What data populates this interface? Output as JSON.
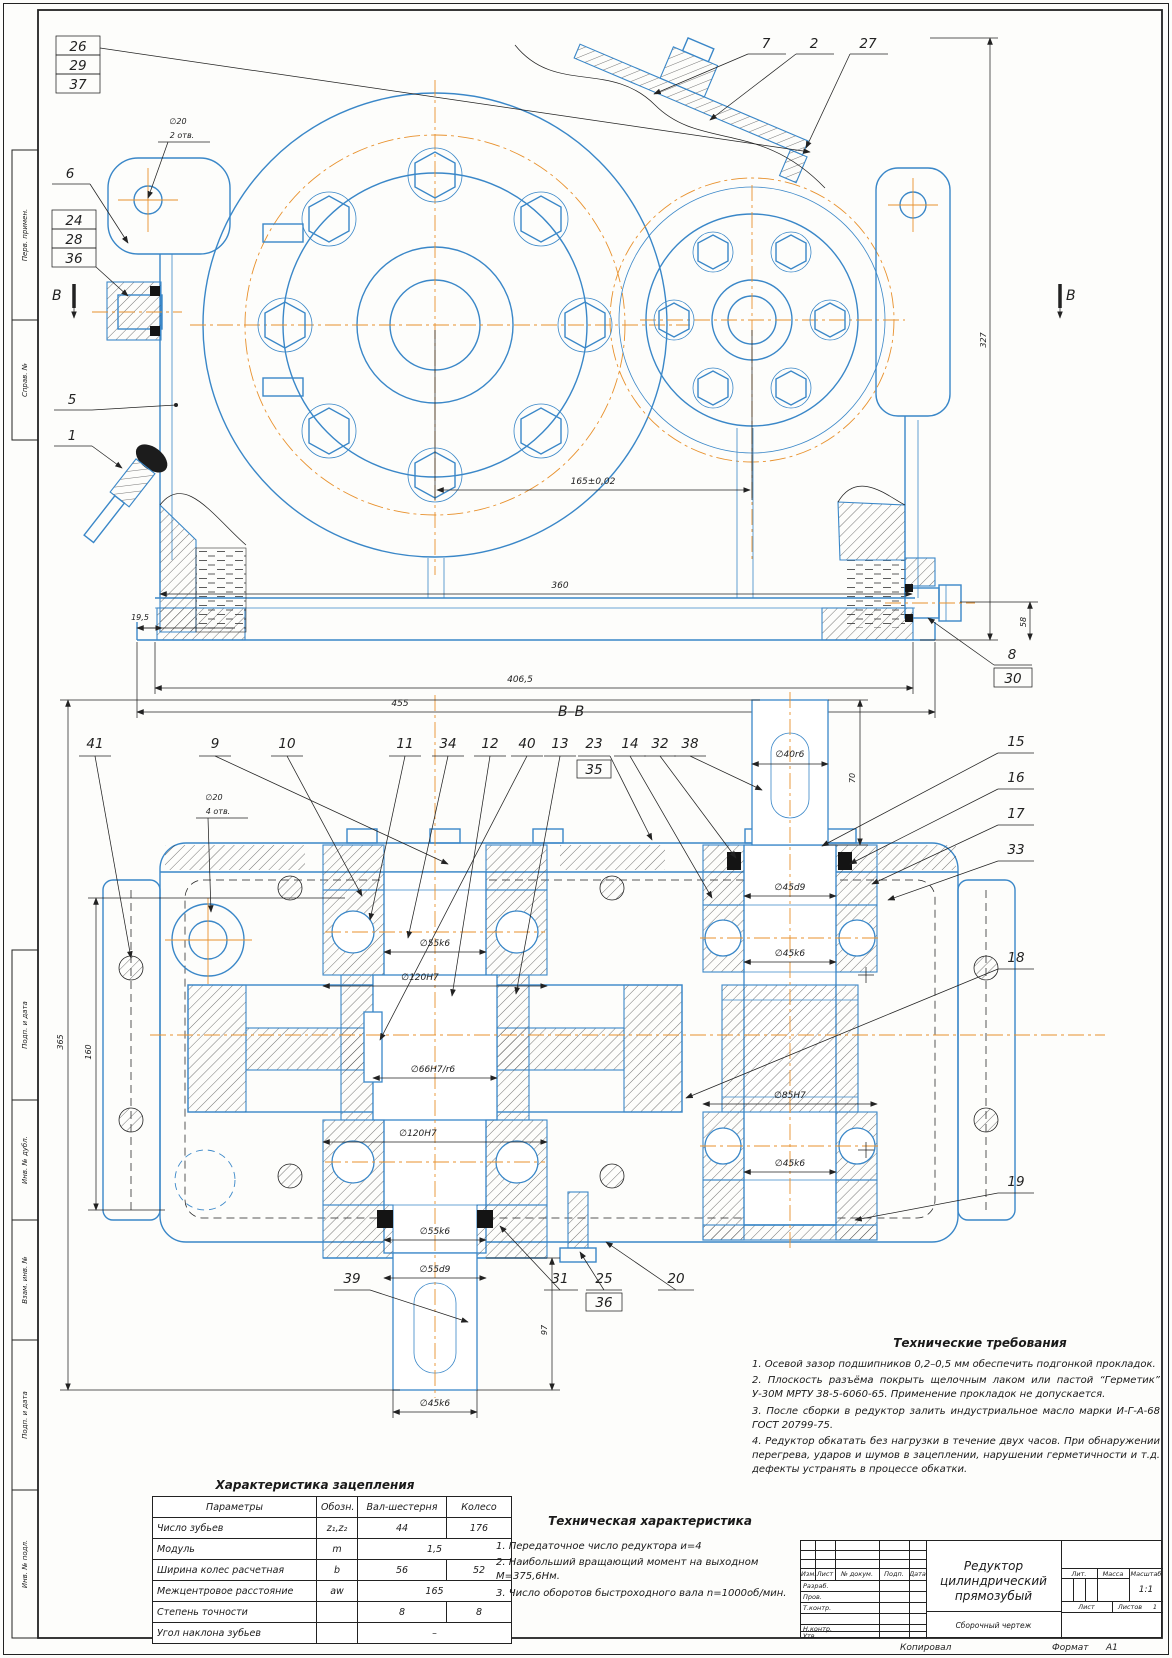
{
  "page": {
    "copy": "Копировал",
    "format_label": "Формат",
    "format_value": "А1"
  },
  "margin": {
    "m1": "Перв. примен.",
    "m2": "Справ. №",
    "m3": "Подп. и дата",
    "m4": "Инв. № дубл.",
    "m5": "Взам. инв. №",
    "m6": "Подп. и дата",
    "m7": "Инв. № подл."
  },
  "tv": {
    "c26": "26",
    "c29": "29",
    "c37": "37",
    "c6": "6",
    "c24": "24",
    "c28": "28",
    "c36": "36",
    "c5": "5",
    "c1": "1",
    "c7": "7",
    "c2": "2",
    "c27": "27",
    "c8": "8",
    "c30": "30",
    "b_left": "В",
    "b_right": "В",
    "hole_d": "∅20",
    "hole_n": "2 отв.",
    "dim_center": "165±0,02",
    "dim_360": "360",
    "dim_406": "406,5",
    "dim_455": "455",
    "dim_19": "19,5",
    "dim_327": "327",
    "dim_58": "58"
  },
  "sv": {
    "title": "В–В",
    "t41": "41",
    "t9": "9",
    "t10": "10",
    "t11": "11",
    "t34": "34",
    "t12": "12",
    "t40": "40",
    "t13": "13",
    "t23": "23",
    "t35": "35",
    "t14": "14",
    "t32": "32",
    "t38": "38",
    "r15": "15",
    "r16": "16",
    "r17": "17",
    "r33": "33",
    "r18": "18",
    "r19": "19",
    "b39": "39",
    "b31": "31",
    "b25": "25",
    "b36": "36",
    "b20": "20",
    "hole_d": "∅20",
    "hole_n": "4 отв.",
    "d40": "∅40r6",
    "d70": "70",
    "d45d9": "∅45d9",
    "d45k6": "∅45k6",
    "d55k6": "∅55k6",
    "d120": "∅120H7",
    "d66": "∅66H7/r6",
    "d85": "∅85H7",
    "d45k6_low": "∅45k6",
    "d120_low": "∅120H7",
    "d55k6_low": "∅55k6",
    "d55d9": "∅55d9",
    "d45k6_stub": "∅45k6",
    "d97": "97",
    "d365": "365",
    "d160": "160"
  },
  "gear_table": {
    "title": "Характеристика зацепления",
    "col_param": "Параметры",
    "col_sym": "Обозн.",
    "col_pinion": "Вал-шестерня",
    "col_wheel": "Колесо",
    "rows": [
      {
        "p": "Число зубьев",
        "s": "z₁,z₂",
        "v1": "44",
        "v2": "176"
      },
      {
        "p": "Модуль",
        "s": "m",
        "v1": "1,5"
      },
      {
        "p": "Ширина колес расчетная",
        "s": "b",
        "v1": "56",
        "v2": "52"
      },
      {
        "p": "Межцентровое расстояние",
        "s": "aw",
        "v1": "165"
      },
      {
        "p": "Степень точности",
        "s": "",
        "v1": "8",
        "v2": "8"
      },
      {
        "p": "Угол наклона зубьев",
        "s": "",
        "v1": "–"
      }
    ]
  },
  "tech_char": {
    "title": "Техническая характеристика",
    "items": [
      "1. Передаточное число редуктора        и=4",
      "2. Наибольший вращающий момент на выходном М=375,6Нм.",
      "3. Число оборотов быстроходного вала n=1000об/мин."
    ]
  },
  "tech_req": {
    "title": "Технические требования",
    "items": [
      "1. Осевой зазор подшипников 0,2–0,5 мм обеспечить подгонкой прокладок.",
      "2. Плоскость разъёма покрыть щелочным лаком или пастой “Герметик” У-30М МРТУ 38-5-6060-65. Применение прокладок не допускается.",
      "3. После сборки в редуктор залить индустриальное масло марки И-Г-А-68 ГОСТ 20799-75.",
      "4. Редуктор обкатать без нагрузки в течение двух часов. При обнаружении перегрева, ударов и шумов в зацеплении, нарушении герметичности и т.д. дефекты устранять в процессе обкатки."
    ]
  },
  "title_block": {
    "doc_title1": "Редуктор цилиндрический",
    "doc_title2": "прямозубый",
    "doc_type": "Сборочный чертеж",
    "scale": "1:1",
    "sheets": "1",
    "lbl_izm": "Изм.",
    "lbl_list": "Лист",
    "lbl_doc": "№ докум.",
    "lbl_sign": "Подп.",
    "lbl_date": "Дата",
    "lbl_razrab": "Разраб.",
    "lbl_prov": "Пров.",
    "lbl_tkontr": "Т.контр.",
    "lbl_nkontr": "Н.контр.",
    "lbl_utv": "Утв.",
    "lbl_lit": "Лит.",
    "lbl_massa": "Масса",
    "lbl_scale": "Масштаб",
    "lbl_sheet": "Лист",
    "lbl_sheets": "Листов"
  }
}
